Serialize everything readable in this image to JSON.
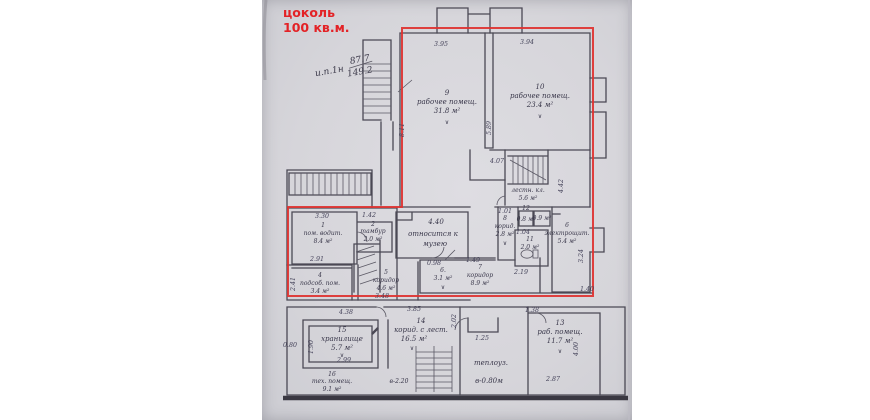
{
  "annotation": {
    "line1": "цоколь",
    "line2": "100 кв.м.",
    "color": "#e32226"
  },
  "handwritten_note": {
    "label": "и.п.1н",
    "upper": "87.7",
    "lower": "149.2"
  },
  "marks": {
    "check": "∨"
  },
  "red_outline_color": "#de3230",
  "rooms": {
    "r1": {
      "num": "1",
      "name": "пом. водит.",
      "area": "8.4 м²"
    },
    "r2": {
      "num": "2",
      "name": "тамбур",
      "area": "2.0 м²"
    },
    "r4": {
      "num": "4",
      "name": "подсоб. пом.",
      "area": "3.4 м²"
    },
    "r5": {
      "num": "5",
      "name": "коридор",
      "area": "4.6 м²"
    },
    "r6": {
      "num": "6.",
      "area": "3.1 м²"
    },
    "r7": {
      "num": "7",
      "name": "коридор",
      "area": "8.9 м²"
    },
    "r8": {
      "num": "8",
      "name": "корид.",
      "area": "2.8 м²"
    },
    "r9": {
      "num": "9",
      "name": "рабочее помещ.",
      "area": "31.8 м²"
    },
    "r10": {
      "num": "10",
      "name": "рабочее помещ.",
      "area": "23.4 м²"
    },
    "r11": {
      "num": "11",
      "name": "с.у.",
      "area": "2.0 м²"
    },
    "r12a": {
      "num": "12",
      "area": "0.8 м²"
    },
    "r12b": {
      "area": "0.9 м²"
    },
    "r13": {
      "num": "13",
      "name": "раб. помещ.",
      "area": "11.7 м²"
    },
    "r14": {
      "num": "14",
      "name": "корид. с лест.",
      "area": "16.5 м²",
      "note": "в-2.20"
    },
    "r15": {
      "num": "15",
      "name": "хранилище",
      "area": "5.7 м²"
    },
    "r16": {
      "num": "16",
      "name": "тех. помещ.",
      "area": "9.1 м²"
    },
    "stair": {
      "name": "лестн. кл.",
      "area": "5.6 м²"
    },
    "elec": {
      "num": "6",
      "name": "электрощит.",
      "area": "5.4 м²"
    },
    "heat": {
      "name": "теплоуз.",
      "note": "в-0.80м"
    },
    "museum": {
      "dim": "4.40",
      "l1": "относится к",
      "l2": "музею"
    }
  },
  "dims": [
    "3.95",
    "3.94",
    "8.11",
    "5.89",
    "4.42",
    "4.07",
    "3.30",
    "1.42",
    "2.91",
    "0.98",
    "1.49",
    "1.01",
    "1.04",
    "2.19",
    "3.24",
    "1.40",
    "2.41",
    "3.48",
    "4.38",
    "3.85",
    "1.90",
    "2.99",
    "0.80",
    "1.25",
    "2.87",
    "4.00",
    "1.38",
    "2.02"
  ]
}
